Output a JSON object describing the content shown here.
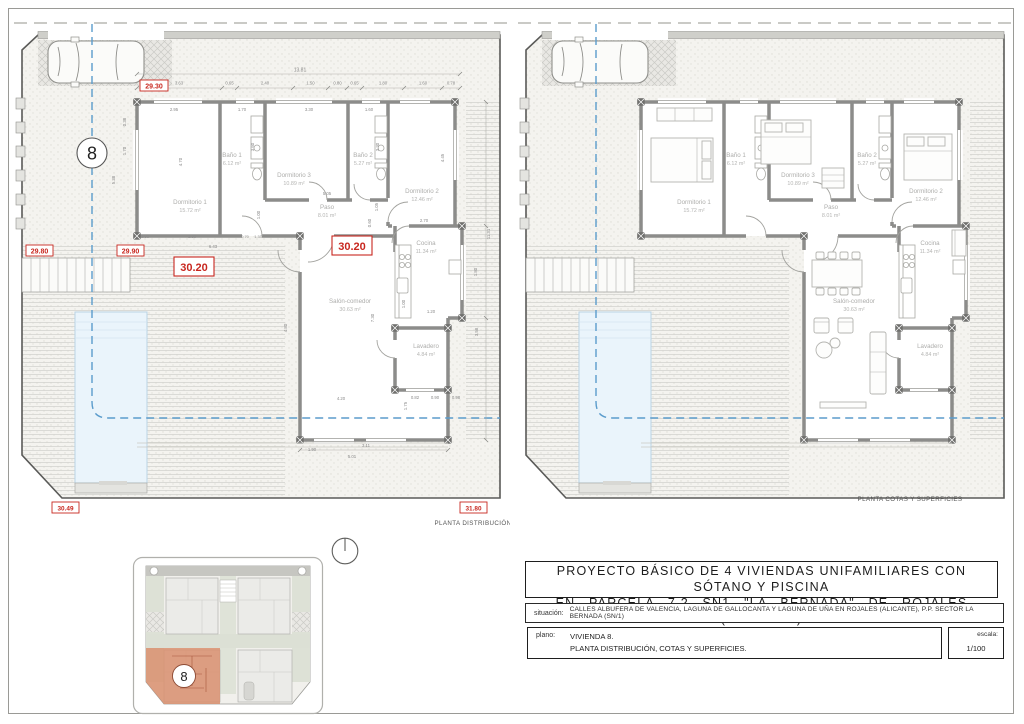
{
  "sheet": {
    "title_line1": "PROYECTO BÁSICO DE 4 VIVIENDAS UNIFAMILIARES CON SÓTANO Y PISCINA",
    "title_line2": "EN PARCELA 7.2 SN1 \"LA BERNADA\" DE ROJALES (ALICANTE)",
    "situacion_label": "situación:",
    "situacion_value": "CALLES ALBUFERA DE VALENCIA, LAGUNA DE GALLOCANTA Y LAGUNA DE UÑA EN ROJALES (ALICANTE), P.P. SECTOR LA BERNADA (SN/1)",
    "plano_label": "plano:",
    "plano_line1": "VIVIENDA 8.",
    "plano_line2": "PLANTA DISTRIBUCIÓN, COTAS Y SUPERFICIES.",
    "escala_label": "escala:",
    "escala_value": "1/100"
  },
  "plans": {
    "left_caption": "PLANTA DISTRIBUCIÓN",
    "right_caption": "PLANTA COTAS Y SUPERFICIES",
    "house_number": "8",
    "rooms": {
      "dorm1": {
        "name": "Dormitorio 1",
        "area": "15.72 m²"
      },
      "bano1": {
        "name": "Baño 1",
        "area": "6.12 m²"
      },
      "dorm3": {
        "name": "Dormitorio 3",
        "area": "10.89 m²"
      },
      "bano2": {
        "name": "Baño 2",
        "area": "5.27 m²"
      },
      "dorm2": {
        "name": "Dormitorio 2",
        "area": "12.46 m²"
      },
      "paso": {
        "name": "Paso",
        "area": "8.01 m²"
      },
      "cocina": {
        "name": "Cocina",
        "area": "11.34 m²"
      },
      "salon": {
        "name": "Salón-comedor",
        "area": "30.63 m²"
      },
      "lavadero": {
        "name": "Lavadero",
        "area": "4.84 m²"
      }
    },
    "cotas": {
      "c1": "29.30",
      "c2": "29.80",
      "c3": "29.90",
      "c4": "30.20",
      "c5": "30.20",
      "c6": "30.49",
      "c7": "31.80"
    },
    "dims": {
      "total": "13.81",
      "top": [
        "3.63",
        "0.65",
        "2.40",
        "1.50",
        "0.80",
        "0.65",
        "1.80",
        "1.60",
        "0.78"
      ],
      "rooms_h": [
        "2.95",
        "1.70",
        "3.30",
        "1.60"
      ],
      "v1": "0.38",
      "v2": "1.70",
      "v3": "5.38",
      "v4": "4.70",
      "v5": "3.60",
      "v6": "3.30",
      "v7": "4.45",
      "v8": "1.05",
      "v9": "0.60",
      "v10": "1.00",
      "v11": "4.80",
      "v12": "7.30",
      "v13": "11.31",
      "v14": "1.80",
      "v15": "3.58",
      "v16": "1.00",
      "v17": "1.75",
      "h1": "3.90",
      "h2": "3.30",
      "h3": "0.70",
      "h4": "1.33",
      "h5": "6.43",
      "h6": "5.05",
      "h7": "2.70",
      "h8": "1.20",
      "h9": "4.20",
      "h10": "0.82",
      "h11": "0.90",
      "h12": "0.98",
      "h13": "1.90",
      "h14": "3.11",
      "h15": "5.01"
    }
  },
  "colors": {
    "cota_red": "#c8271f",
    "axis_blue": "#5b9ccc",
    "pool_blue": "#eaf4fb",
    "highlight_salmon": "#d98f6f"
  }
}
